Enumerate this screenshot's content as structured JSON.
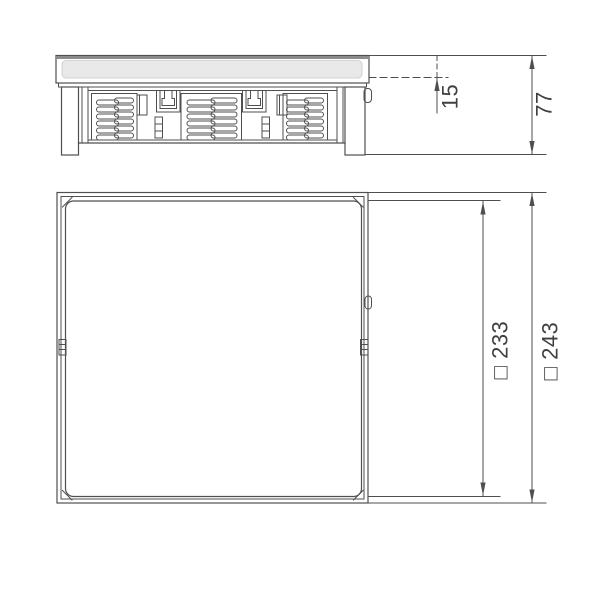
{
  "colors": {
    "line": "#4f4f4f",
    "thick_line": "#8c8c8c",
    "gray_fill": "#e9e9e9",
    "gray_stroke": "#c9c9c9",
    "text": "#3f3f3f",
    "background": "#ffffff"
  },
  "dimensions": {
    "side_recess": {
      "label": "15",
      "value": 15
    },
    "side_height": {
      "label": "77",
      "value": 77
    },
    "plan_inner": {
      "label": "□ 233",
      "value": 233
    },
    "plan_outer": {
      "label": "□ 243",
      "value": 243
    }
  }
}
